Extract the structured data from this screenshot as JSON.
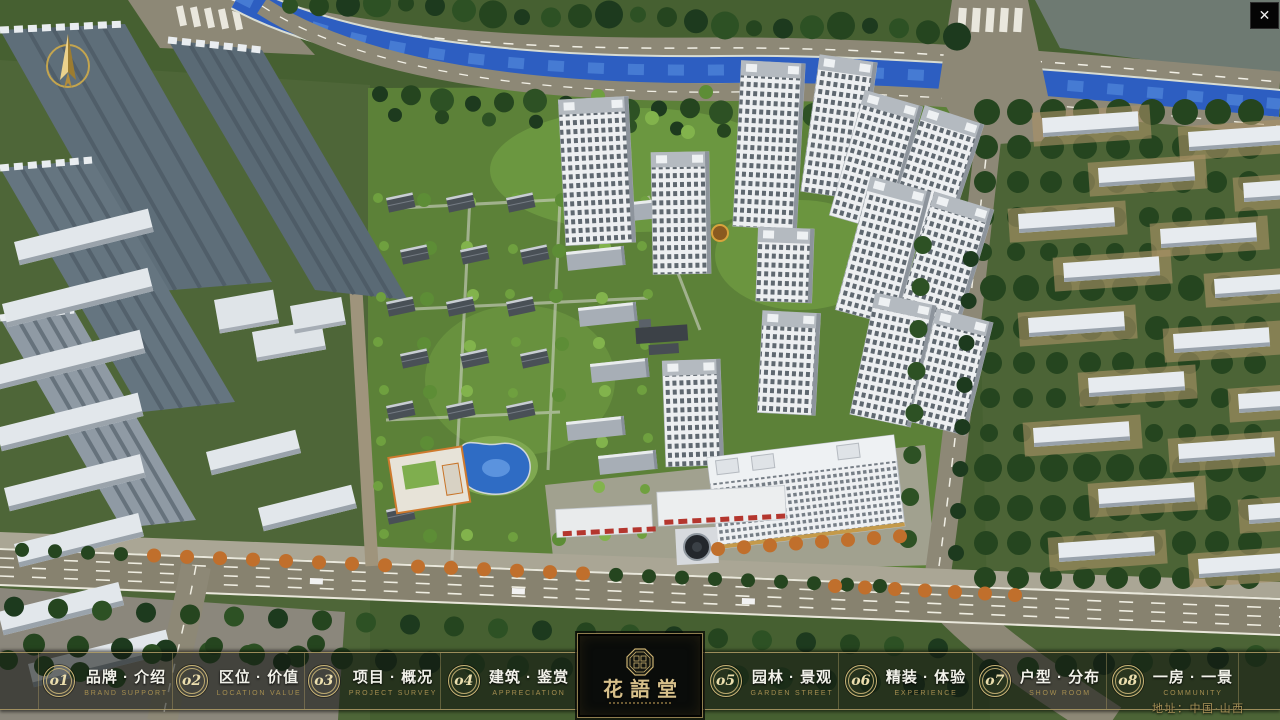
{
  "window": {
    "close_icon": "✕"
  },
  "scene": {
    "address": "地址：中国·山西"
  },
  "logo": {
    "title": "花語堂"
  },
  "colors": {
    "accent_gold": "#c9b476",
    "bar_background": "rgba(15,19,15,0.58)",
    "river_blue": "#2d5ec1"
  },
  "navbar": {
    "items": [
      {
        "number": "o1",
        "label": "品牌 · 介绍",
        "sublabel": "BRAND SUPPORT"
      },
      {
        "number": "o2",
        "label": "区位 · 价值",
        "sublabel": "LOCATION VALUE"
      },
      {
        "number": "o3",
        "label": "项目 · 概况",
        "sublabel": "PROJECT SURVEY"
      },
      {
        "number": "o4",
        "label": "建筑 · 鉴赏",
        "sublabel": "APPRECIATION"
      },
      {
        "number": "o5",
        "label": "园林 · 景观",
        "sublabel": "GARDEN STREET"
      },
      {
        "number": "o6",
        "label": "精装 · 体验",
        "sublabel": "EXPERIENCE"
      },
      {
        "number": "o7",
        "label": "户型 · 分布",
        "sublabel": "SHOW ROOM"
      },
      {
        "number": "o8",
        "label": "一房 · 一景",
        "sublabel": "COMMUNITY"
      }
    ]
  }
}
